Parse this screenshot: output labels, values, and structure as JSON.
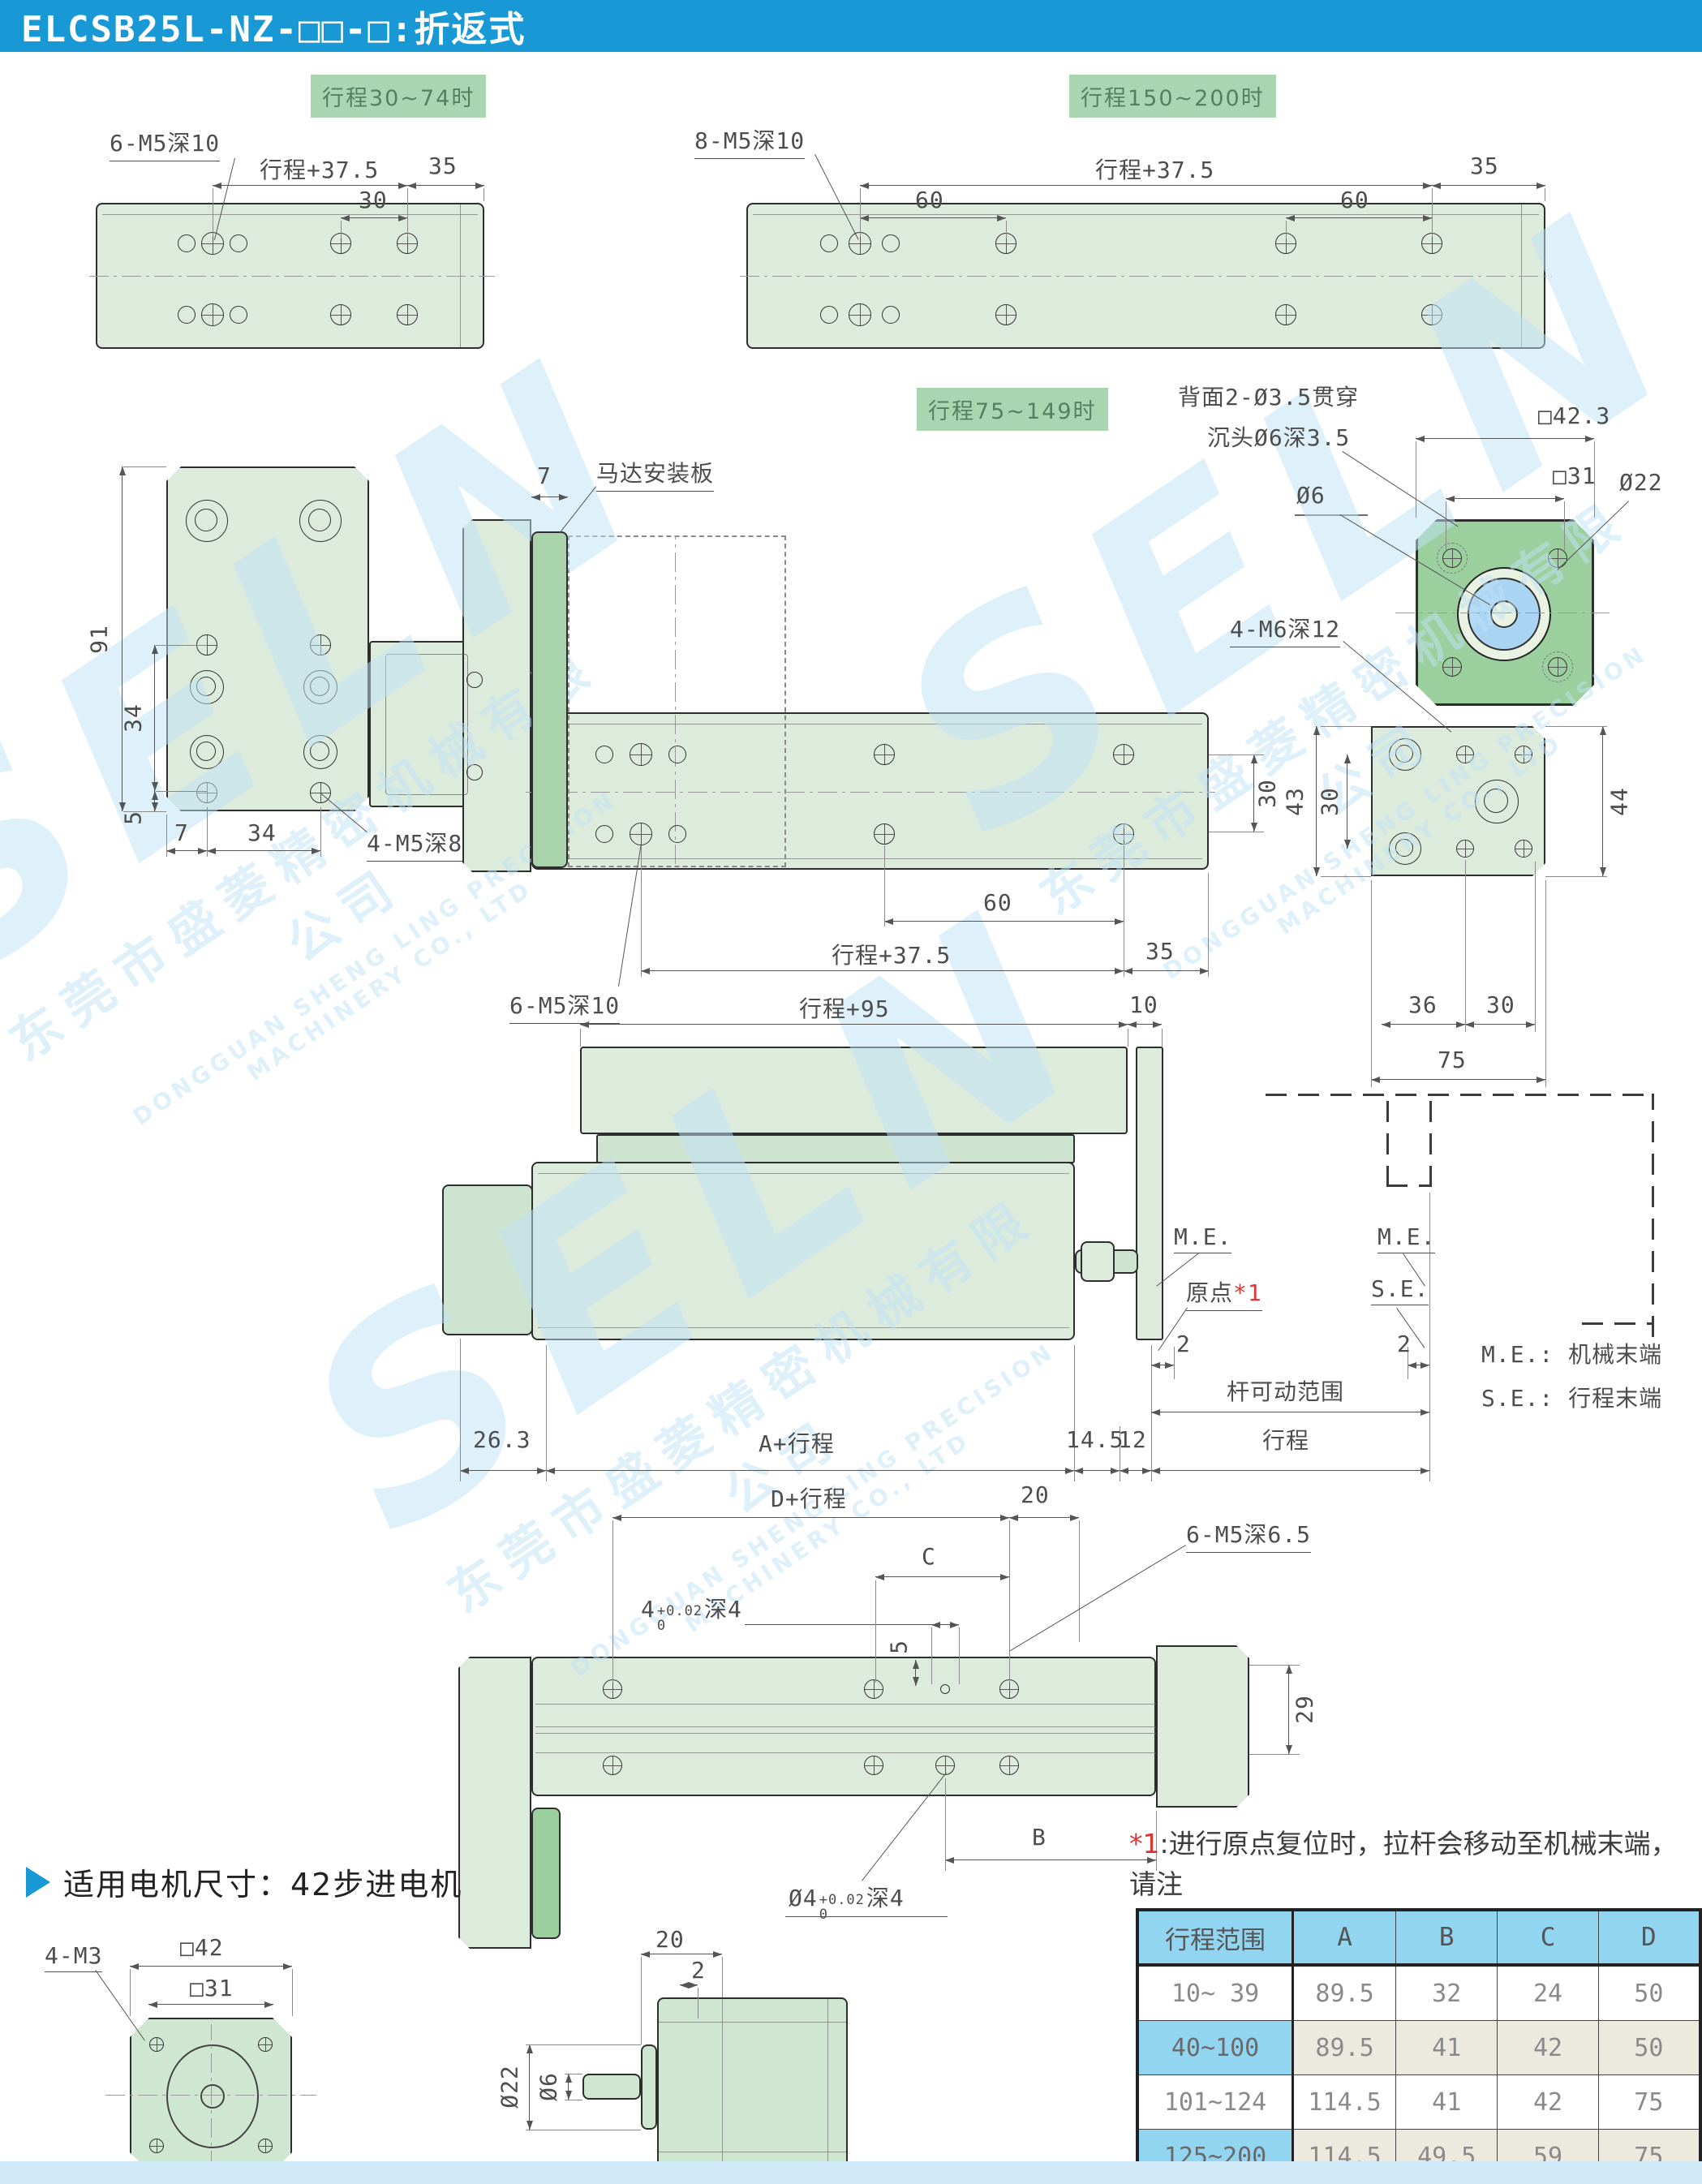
{
  "header": {
    "title": "ELCSB25L-NZ-□□-□:折返式"
  },
  "watermark": {
    "brand": "SELN",
    "company_cn": "东莞市盛菱精密机械有限公司",
    "company_en": "DONGGUAN SHENG LING PRECISION MACHINERY CO., LTD"
  },
  "views": {
    "stroke_short": {
      "tag": "行程30~74时",
      "leader": "6-M5深10",
      "dim_main": "行程+37.5",
      "dim_sub": "30",
      "dim_end": "35"
    },
    "stroke_long": {
      "tag": "行程150~200时",
      "leader": "8-M5深10",
      "dim_main": "行程+37.5",
      "dim_sub1": "60",
      "dim_sub2": "60",
      "dim_end": "35"
    },
    "bracket": {
      "dim_height": "91",
      "dim_mid": "34",
      "dim_low": "5",
      "dim_b1": "7",
      "dim_b2": "34",
      "leader": "4-M5深8"
    },
    "front": {
      "tag": "行程75~149时",
      "leader_plate": "马达安装板",
      "dim_plate": "7",
      "leader_holes": "6-M5深10",
      "dim_main": "行程+37.5",
      "dim_sub": "60",
      "dim_end": "35",
      "dim_side": "30"
    },
    "flange": {
      "note1": "背面2-Ø3.5贯穿",
      "note2": "沉头Ø6深3.5",
      "dim_sq_outer": "□42.3",
      "dim_sq_inner": "□31",
      "dim_bore": "Ø6",
      "dim_pilot": "Ø22",
      "leader": "4-M6深12"
    },
    "end": {
      "dim_height": "43",
      "dim_holes": "30",
      "dim_right": "44",
      "dim_b1": "36",
      "dim_b2": "30",
      "dim_total": "75"
    },
    "side": {
      "dim_top": "行程+95",
      "dim_10": "10",
      "me": "M.E.",
      "origin": "原点",
      "ref": "*1",
      "se": "S.E.",
      "dim_2a": "2",
      "dim_2b": "2",
      "rod_range": "杆可动范围",
      "stroke": "行程",
      "dim_263": "26.3",
      "dim_a": "A+行程",
      "dim_145": "14.5",
      "dim_12": "12",
      "legend_me": "M.E.: 机械末端",
      "legend_se": "S.E.: 行程末端"
    },
    "top": {
      "dim_d": "D+行程",
      "dim_20": "20",
      "dim_c": "C",
      "pin_base": "4",
      "tol_up": "+0.02",
      "tol_dn": "0",
      "pin_depth": "深4",
      "leader": "6-M5深6.5",
      "dim_5": "5",
      "dim_29": "29",
      "dim_b": "B",
      "pin2_base": "Ø4",
      "tol2_up": "+0.02",
      "tol2_dn": "0",
      "pin2_depth": "深4"
    }
  },
  "note": {
    "ref": "*1",
    "line1": ":进行原点复位时，拉杆会移动至机械末端，请注",
    "line2": "意不要与周围工件、设备产生干涉。"
  },
  "table": {
    "headers": [
      "行程范围",
      "A",
      "B",
      "C",
      "D"
    ],
    "rows": [
      [
        "10~ 39",
        "89.5",
        "32",
        "24",
        "50"
      ],
      [
        "40~100",
        "89.5",
        "41",
        "42",
        "50"
      ],
      [
        "101~124",
        "114.5",
        "41",
        "42",
        "75"
      ],
      [
        "125~200",
        "114.5",
        "49.5",
        "59",
        "75"
      ]
    ]
  },
  "motor": {
    "title": "适用电机尺寸：42步进电机",
    "leader": "4-M3",
    "sq42": "□42",
    "sq31": "□31",
    "dim20": "20",
    "dim2": "2",
    "d22": "Ø22",
    "d6": "Ø6"
  },
  "colors": {
    "accent": "#1898d4",
    "chip": "#a9d6b0",
    "table_header": "#92d5f1",
    "fill": "#dcebdc",
    "flange": "#9ccf9e",
    "bore_blue": "#a9d5f2"
  }
}
